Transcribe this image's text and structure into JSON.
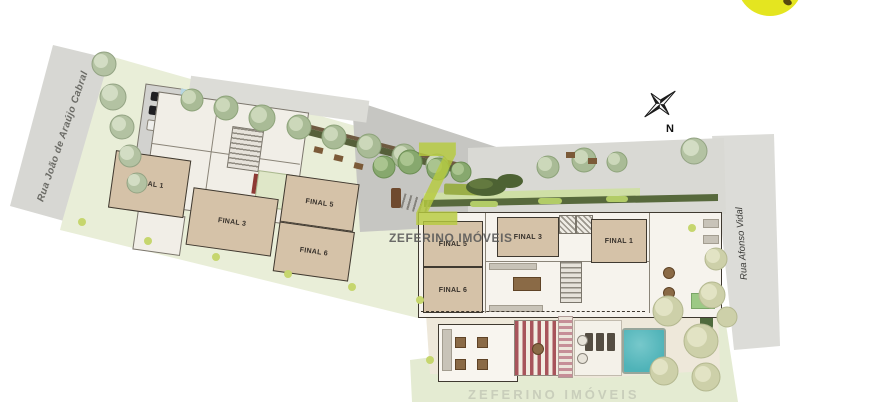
{
  "site_plan": {
    "streets": [
      {
        "name": "Rua João de Araújo Cabral",
        "side": "left"
      },
      {
        "name": "Rua Afonso Vidal",
        "side": "right"
      }
    ],
    "compass": {
      "north_label": "N"
    },
    "watermark": {
      "logo_letter": "Z",
      "company_name": "ZEFERINO IMÓVEIS"
    },
    "tower_left": {
      "units": [
        "FINAL 1",
        "FINAL 3",
        "FINAL 5",
        "FINAL 6"
      ]
    },
    "tower_right": {
      "units": [
        "FINAL 5",
        "FINAL 3",
        "FINAL 1",
        "FINAL 6"
      ]
    },
    "colors": {
      "lawn": "#e9eed8",
      "lawn_dark": "#e2e9cf",
      "street": "#d7d7d3",
      "paving": "#d9d9d4",
      "driveway": "#c6c6c2",
      "deck": "#eee8da",
      "unit_fill": "#d5c2a8",
      "unit_border": "#3f3930",
      "pool": "#4fb3b8",
      "hedge": "#56603a",
      "watermark_green": "#b6cb3e",
      "highlight_yellow": "#e4e520"
    }
  }
}
